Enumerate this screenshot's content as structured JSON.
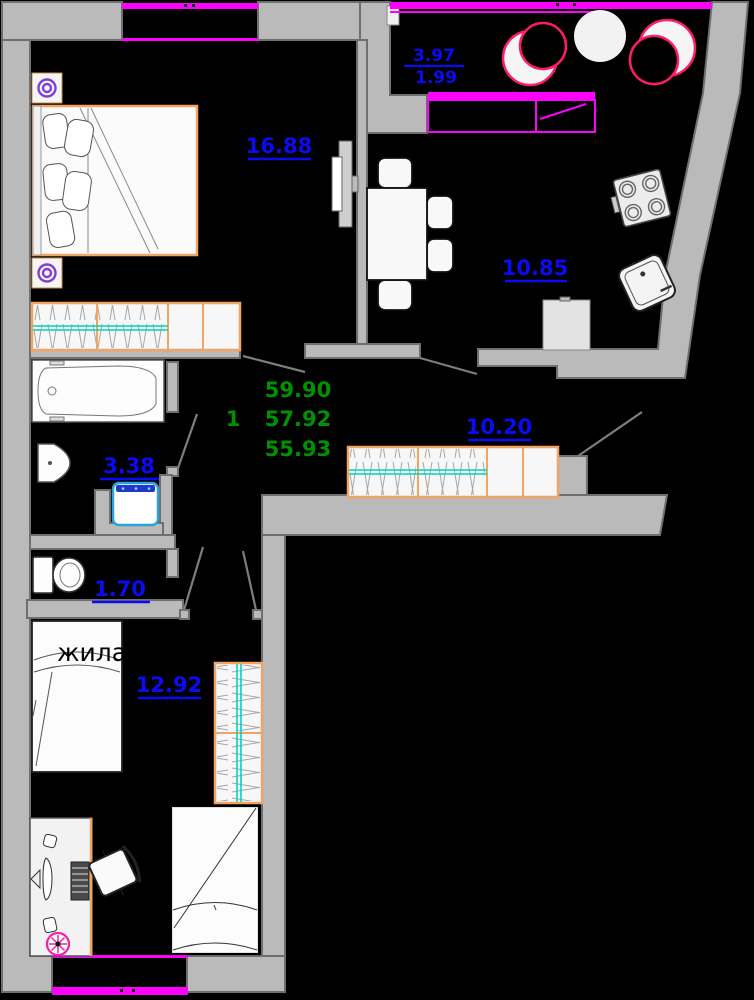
{
  "colors": {
    "background": "#000000",
    "wall_gray": "#bababa",
    "wall_edge": "#6f6f6f",
    "label_blue": "#0a0af5",
    "total_green": "#009100",
    "window_magenta": "#fb02fb",
    "furniture_orange": "#f2a464",
    "accent_teal": "#00d2c4",
    "washer_cyan": "#29a3dc",
    "washer_band_blue": "#2238c8",
    "decor_pink": "#fd1c68",
    "lamp_purple": "#8040d8",
    "flower_pink": "#ee22aa"
  },
  "rooms": {
    "bedroom": {
      "area": "16.88"
    },
    "kitchen": {
      "area": "10.85"
    },
    "hall": {
      "area": "10.20"
    },
    "bathroom": {
      "area": "3.38"
    },
    "wc": {
      "area": "1.70"
    },
    "living": {
      "area": "12.92",
      "label": "жилая"
    },
    "balcony": {
      "area_full": "3.97",
      "area_coef": "1.99"
    }
  },
  "summary": {
    "rooms_count": "1",
    "area_line1": "59.90",
    "area_line2": "57.92",
    "area_line3": "55.93"
  }
}
